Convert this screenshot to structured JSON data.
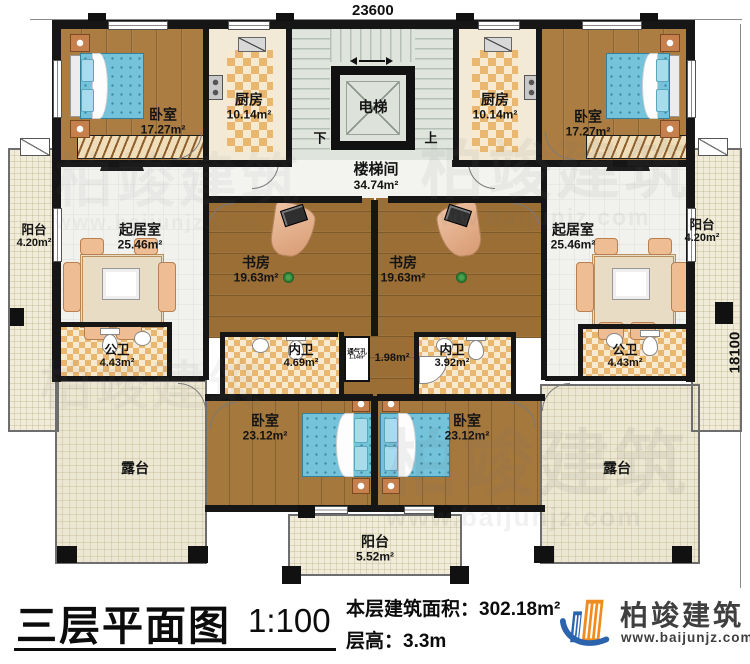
{
  "dimensions": {
    "top": "23600",
    "right": "18100"
  },
  "core": {
    "elevator": "电梯",
    "stairwell": "楼梯间",
    "stairwell_area": "34.74m²",
    "down": "下",
    "up": "上"
  },
  "vent": {
    "label": "通气孔",
    "area": "1.14m²",
    "shaft_area": "1.98m²"
  },
  "rooms": [
    {
      "id": "bedroom-top-left",
      "label": "卧室",
      "area": "17.27m²"
    },
    {
      "id": "kitchen-left",
      "label": "厨房",
      "area": "10.14m²"
    },
    {
      "id": "kitchen-right",
      "label": "厨房",
      "area": "10.14m²"
    },
    {
      "id": "bedroom-top-right",
      "label": "卧室",
      "area": "17.27m²"
    },
    {
      "id": "balcony-left",
      "label": "阳台",
      "area": "4.20m²"
    },
    {
      "id": "living-left",
      "label": "起居室",
      "area": "25.46m²"
    },
    {
      "id": "study-left",
      "label": "书房",
      "area": "19.63m²"
    },
    {
      "id": "study-right",
      "label": "书房",
      "area": "19.63m²"
    },
    {
      "id": "living-right",
      "label": "起居室",
      "area": "25.46m²"
    },
    {
      "id": "balcony-right",
      "label": "阳台",
      "area": "4.20m²"
    },
    {
      "id": "bath-public-left",
      "label": "公卫",
      "area": "4.43m²"
    },
    {
      "id": "bath-inner-left",
      "label": "内卫",
      "area": "4.69m²"
    },
    {
      "id": "bath-inner-right",
      "label": "内卫",
      "area": "3.92m²"
    },
    {
      "id": "bath-public-right",
      "label": "公卫",
      "area": "4.43m²"
    },
    {
      "id": "bedroom-bottom-left",
      "label": "卧室",
      "area": "23.12m²"
    },
    {
      "id": "bedroom-bottom-right",
      "label": "卧室",
      "area": "23.12m²"
    },
    {
      "id": "terrace-left",
      "label": "露台"
    },
    {
      "id": "terrace-right",
      "label": "露台"
    },
    {
      "id": "balcony-bottom",
      "label": "阳台",
      "area": "5.52m²"
    }
  ],
  "titleblock": {
    "title": "三层平面图",
    "scale": "1:100",
    "area_label": "本层建筑面积：",
    "area_value": "302.18m²",
    "floor_height_label": "层高：",
    "floor_height_value": "3.3m"
  },
  "logo": {
    "name": "柏竣建筑",
    "site": "www.baijunjz.com",
    "icon": "building-swoosh-icon"
  },
  "watermark": {
    "name": "柏竣建筑",
    "site": "www.baijunjz.com"
  },
  "colors": {
    "wall": "#161616",
    "wood": "#ab7d43",
    "tile": "#e9b76f",
    "mattress": "#74c3da",
    "logo_blue": "#2b63ac",
    "logo_orange": "#f08c1f"
  }
}
